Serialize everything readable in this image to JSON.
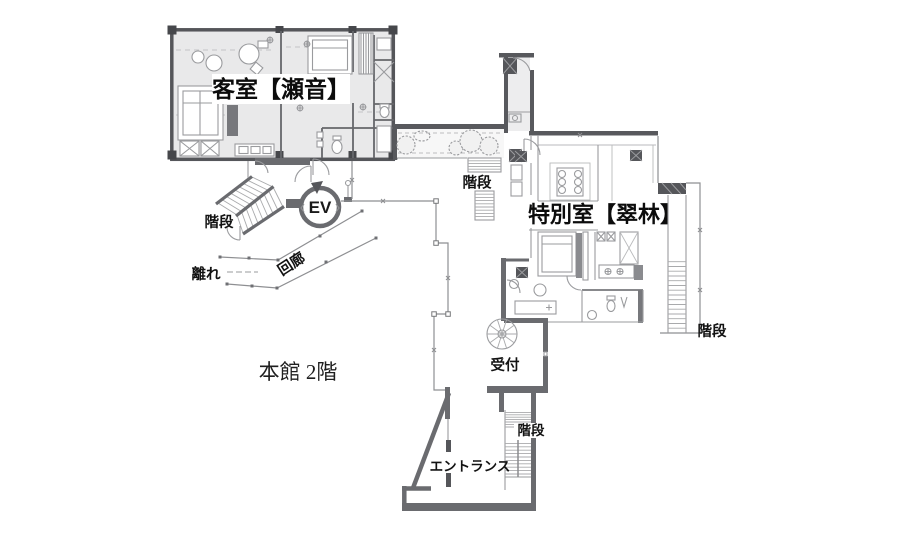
{
  "plan": {
    "floor_label": "本館 2階",
    "labels": {
      "guest_room": "客室【瀬音】",
      "special_room": "特別室【翠林】",
      "elevator": "EV",
      "corridor": "回廊",
      "hanare": "離れ",
      "reception": "受付",
      "entrance": "エントランス",
      "stairs_left": "階段",
      "stairs_mid": "階段",
      "stairs_right": "階段",
      "stairs_entrance": "階段"
    },
    "colors": {
      "wall_dark": "#55565a",
      "pillar": "#46474b",
      "wall": "#6a6b6f",
      "room_fill": "#e9e9ea",
      "thin_line": "#9a9b9e",
      "text": "#111111",
      "background": "#ffffff"
    }
  }
}
